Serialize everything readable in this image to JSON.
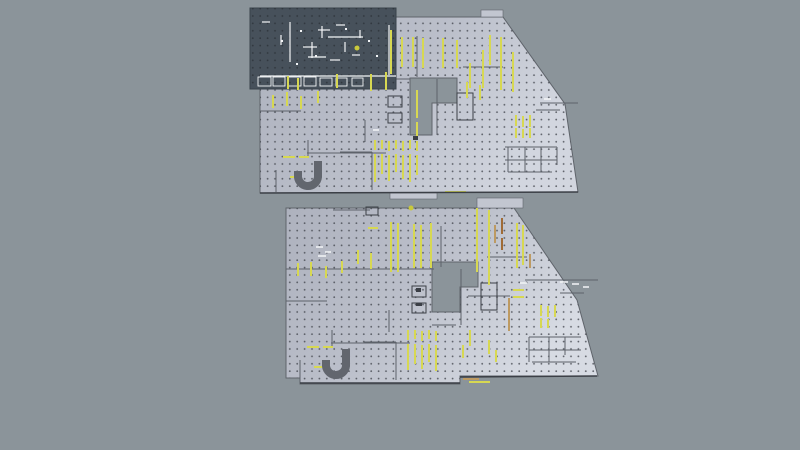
{
  "canvas": {
    "width": 800,
    "height": 450,
    "background": "#8b949a"
  },
  "colors": {
    "floor_fill_left": "#aeb2be",
    "floor_fill_mid": "#bbbfca",
    "floor_fill_right": "#d2d6df",
    "grid_dot": "#42464d",
    "grid_dot_dark": "#2f353c",
    "wall": "#5d626a",
    "wall_dark": "#3b3f46",
    "outline": "#5f646b",
    "annex_fill": "#c2c6d0",
    "marking_yellow": "#d7d852",
    "marking_tan": "#bd9a62",
    "marking_orange": "#a06b36",
    "highlight_white": "#f3f5f7",
    "selection_fill": "#47515b",
    "selection_border": "#39424b",
    "ramp_gray": "#62666e",
    "yellow_dot": "#c9c93c"
  },
  "floors": [
    {
      "id": "upper-floor",
      "gradient": "gradUpper",
      "outline_path": "M260,17 L503,17 L565,104 L578,192 L260,193 Z M410,78 L457,78 L457,103 L432,103 L432,135 L410,135 Z",
      "annexes": [
        [
          481,
          10,
          22,
          7
        ],
        [
          390,
          193,
          47,
          6
        ]
      ],
      "walls": [
        [
          260,
          79,
          410,
          79
        ],
        [
          260,
          111,
          301,
          111
        ],
        [
          307,
          153,
          386,
          153
        ],
        [
          365,
          120,
          365,
          142
        ],
        [
          308,
          140,
          308,
          157
        ],
        [
          417,
          36,
          417,
          77
        ],
        [
          437,
          79,
          437,
          135
        ],
        [
          457,
          90,
          457,
          103
        ],
        [
          463,
          67,
          503,
          67
        ],
        [
          540,
          103,
          578,
          103
        ],
        [
          536,
          110,
          560,
          110
        ],
        [
          505,
          147,
          557,
          147
        ],
        [
          505,
          160,
          557,
          160
        ],
        [
          508,
          172,
          552,
          172
        ],
        [
          508,
          147,
          508,
          172
        ],
        [
          525,
          147,
          525,
          172
        ],
        [
          541,
          147,
          541,
          172
        ],
        [
          557,
          147,
          557,
          165
        ],
        [
          340,
          152,
          372,
          152
        ],
        [
          372,
          152,
          372,
          190
        ],
        [
          276,
          170,
          276,
          192
        ],
        [
          410,
          135,
          432,
          135
        ]
      ],
      "rooms": [
        [
          388,
          96,
          14,
          11
        ],
        [
          388,
          113,
          14,
          10
        ],
        [
          457,
          93,
          16,
          27
        ]
      ],
      "yellow_v": [
        [
          273,
          95,
          13
        ],
        [
          287,
          92,
          14
        ],
        [
          301,
          96,
          13
        ],
        [
          318,
          91,
          12
        ],
        [
          387,
          33,
          42
        ],
        [
          402,
          37,
          30
        ],
        [
          413,
          37,
          30
        ],
        [
          423,
          38,
          30
        ],
        [
          443,
          38,
          30
        ],
        [
          457,
          40,
          28
        ],
        [
          470,
          63,
          25
        ],
        [
          483,
          50,
          38
        ],
        [
          490,
          35,
          30
        ],
        [
          501,
          37,
          53
        ],
        [
          513,
          52,
          40
        ],
        [
          467,
          82,
          16
        ],
        [
          480,
          85,
          15
        ],
        [
          417,
          90,
          28
        ],
        [
          417,
          122,
          16
        ],
        [
          375,
          140,
          10
        ],
        [
          382,
          140,
          9
        ],
        [
          389,
          141,
          10
        ],
        [
          396,
          140,
          9
        ],
        [
          403,
          141,
          10
        ],
        [
          410,
          140,
          9
        ],
        [
          417,
          141,
          10
        ],
        [
          375,
          154,
          28
        ],
        [
          382,
          154,
          20
        ],
        [
          389,
          155,
          26
        ],
        [
          396,
          154,
          18
        ],
        [
          403,
          155,
          24
        ],
        [
          410,
          154,
          28
        ],
        [
          417,
          155,
          20
        ],
        [
          516,
          115,
          11
        ],
        [
          523,
          116,
          11
        ],
        [
          530,
          115,
          12
        ],
        [
          516,
          128,
          10
        ],
        [
          523,
          129,
          9
        ],
        [
          530,
          128,
          10
        ]
      ],
      "yellow_h": [
        [
          283,
          157,
          12
        ],
        [
          299,
          157,
          10
        ],
        [
          290,
          177,
          9
        ],
        [
          445,
          192,
          21
        ]
      ],
      "tan_v": [],
      "tan_h": [],
      "orange_v": [],
      "white_h": [
        [
          373,
          130,
          6
        ],
        [
          544,
          99,
          7
        ]
      ],
      "dark_marks": [
        [
          413,
          136,
          5,
          4
        ]
      ],
      "edges": [
        [
          260,
          193,
          578,
          192
        ]
      ],
      "ramp_path": "M318,161 L318,177 A10,10 0 0 1 298,175 L298,171",
      "yellow_dot": null
    },
    {
      "id": "lower-floor",
      "gradient": "gradLower",
      "outline_path": "M286,208 L514,208 L577,300 L598,376 L460,376 L460,384 L300,384 L300,378 L286,378 Z M432,262 L478,262 L478,287 L460,287 L460,312 L432,312 Z",
      "annexes": [
        [
          477,
          198,
          46,
          10
        ]
      ],
      "walls": [
        [
          286,
          269,
          434,
          269
        ],
        [
          286,
          301,
          327,
          301
        ],
        [
          331,
          343,
          410,
          343
        ],
        [
          389,
          310,
          389,
          332
        ],
        [
          332,
          330,
          332,
          347
        ],
        [
          441,
          226,
          441,
          267
        ],
        [
          461,
          269,
          461,
          325
        ],
        [
          487,
          257,
          527,
          257
        ],
        [
          525,
          280,
          598,
          280
        ],
        [
          560,
          293,
          584,
          293
        ],
        [
          529,
          337,
          581,
          337
        ],
        [
          529,
          350,
          581,
          350
        ],
        [
          532,
          362,
          576,
          362
        ],
        [
          529,
          337,
          529,
          362
        ],
        [
          549,
          337,
          549,
          362
        ],
        [
          565,
          337,
          565,
          355
        ],
        [
          364,
          342,
          396,
          342
        ],
        [
          396,
          342,
          396,
          380
        ],
        [
          300,
          360,
          300,
          383
        ],
        [
          432,
          325,
          456,
          325
        ],
        [
          468,
          296,
          510,
          296
        ],
        [
          333,
          210,
          370,
          210
        ]
      ],
      "rooms": [
        [
          412,
          286,
          14,
          11
        ],
        [
          412,
          303,
          14,
          10
        ],
        [
          481,
          283,
          16,
          27
        ],
        [
          366,
          207,
          12,
          8
        ]
      ],
      "yellow_v": [
        [
          298,
          263,
          13
        ],
        [
          311,
          262,
          14
        ],
        [
          326,
          266,
          12
        ],
        [
          342,
          261,
          12
        ],
        [
          391,
          222,
          50
        ],
        [
          398,
          223,
          49
        ],
        [
          414,
          224,
          44
        ],
        [
          421,
          225,
          43
        ],
        [
          431,
          223,
          45
        ],
        [
          477,
          208,
          64
        ],
        [
          489,
          210,
          75
        ],
        [
          517,
          223,
          45
        ],
        [
          523,
          225,
          40
        ],
        [
          371,
          253,
          16
        ],
        [
          358,
          250,
          14
        ],
        [
          408,
          330,
          10
        ],
        [
          415,
          330,
          9
        ],
        [
          422,
          331,
          10
        ],
        [
          429,
          330,
          9
        ],
        [
          436,
          331,
          10
        ],
        [
          408,
          344,
          26
        ],
        [
          415,
          344,
          20
        ],
        [
          422,
          345,
          24
        ],
        [
          429,
          344,
          18
        ],
        [
          436,
          345,
          26
        ],
        [
          541,
          305,
          11
        ],
        [
          548,
          306,
          11
        ],
        [
          555,
          305,
          12
        ],
        [
          541,
          318,
          10
        ],
        [
          548,
          319,
          9
        ],
        [
          496,
          350,
          12
        ],
        [
          489,
          340,
          14
        ],
        [
          470,
          330,
          16
        ],
        [
          463,
          345,
          13
        ]
      ],
      "yellow_h": [
        [
          307,
          347,
          12
        ],
        [
          323,
          347,
          10
        ],
        [
          314,
          367,
          9
        ],
        [
          469,
          382,
          21
        ],
        [
          513,
          290,
          11
        ],
        [
          513,
          297,
          11
        ],
        [
          368,
          228,
          10
        ]
      ],
      "tan_v": [
        [
          509,
          298,
          33
        ],
        [
          530,
          254,
          14
        ],
        [
          495,
          225,
          18
        ]
      ],
      "tan_h": [
        [
          463,
          379,
          16
        ]
      ],
      "orange_v": [
        [
          502,
          218,
          16
        ],
        [
          502,
          238,
          12
        ]
      ],
      "white_h": [
        [
          560,
          282,
          8
        ],
        [
          572,
          284,
          7
        ],
        [
          583,
          287,
          6
        ],
        [
          520,
          283,
          7
        ],
        [
          316,
          247,
          7
        ],
        [
          325,
          252,
          6
        ],
        [
          318,
          256,
          8
        ]
      ],
      "dark_marks": [
        [
          416,
          288,
          5,
          4
        ],
        [
          416,
          303,
          6,
          3
        ]
      ],
      "edges": [
        [
          300,
          383,
          460,
          383
        ],
        [
          460,
          377,
          597,
          376
        ]
      ],
      "ramp_path": "M346,349 L346,366 A10,10 0 0 1 326,364 L326,360",
      "yellow_dot": [
        411,
        208
      ]
    }
  ],
  "selection": {
    "x": 250,
    "y": 8,
    "width": 146,
    "height": 81,
    "white_h": [
      [
        328,
        37,
        35
      ],
      [
        318,
        30,
        12
      ],
      [
        336,
        25,
        9
      ],
      [
        303,
        47,
        14
      ],
      [
        308,
        57,
        18
      ],
      [
        330,
        60,
        10
      ],
      [
        260,
        76,
        136
      ],
      [
        262,
        22,
        8
      ],
      [
        352,
        55,
        8
      ]
    ],
    "white_v": [
      [
        290,
        22,
        40
      ],
      [
        312,
        42,
        16
      ],
      [
        322,
        26,
        12
      ],
      [
        389,
        25,
        50
      ],
      [
        281,
        35,
        10
      ],
      [
        345,
        42,
        10
      ],
      [
        360,
        30,
        8
      ]
    ],
    "boxes": [
      [
        258,
        77,
        13,
        9
      ],
      [
        273,
        77,
        12,
        9
      ],
      [
        288,
        77,
        13,
        9
      ],
      [
        304,
        77,
        12,
        9
      ],
      [
        320,
        78,
        12,
        8
      ],
      [
        336,
        78,
        11,
        8
      ],
      [
        352,
        78,
        11,
        8
      ]
    ],
    "yellow_v": [
      [
        288,
        76,
        13
      ],
      [
        298,
        78,
        12
      ],
      [
        337,
        74,
        14
      ],
      [
        371,
        74,
        17
      ],
      [
        386,
        72,
        18
      ],
      [
        391,
        30,
        44
      ]
    ],
    "specks": [
      [
        300,
        30
      ],
      [
        345,
        28
      ],
      [
        281,
        40
      ],
      [
        315,
        55
      ],
      [
        368,
        40
      ],
      [
        376,
        55
      ],
      [
        296,
        63
      ]
    ],
    "yellow_dot": [
      357,
      48
    ]
  }
}
